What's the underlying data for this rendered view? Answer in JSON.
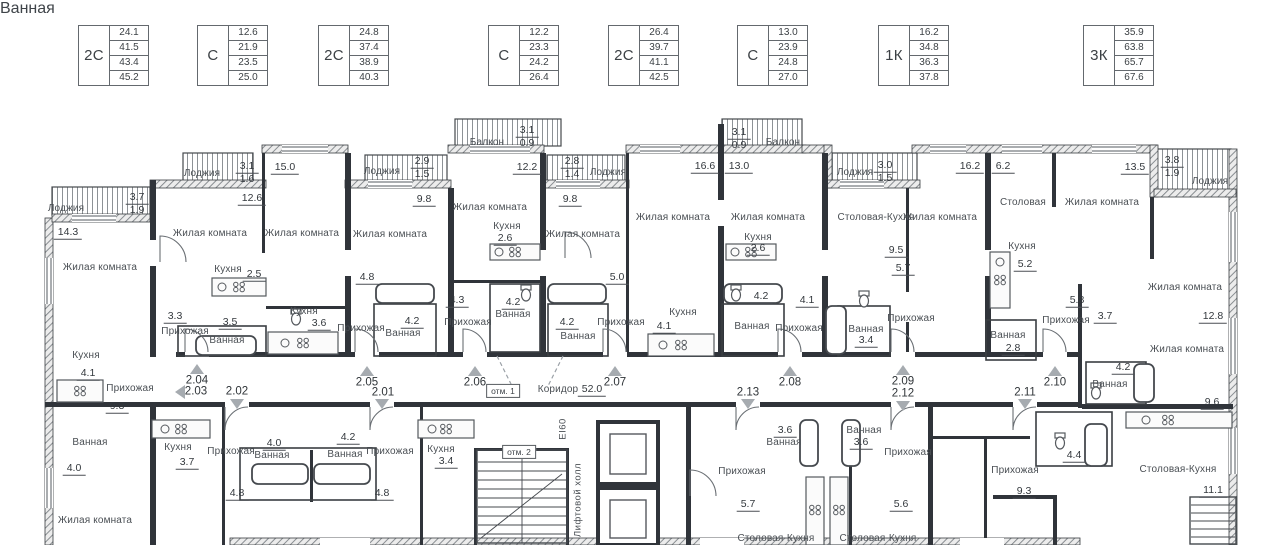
{
  "legend": [
    {
      "type": "2С",
      "values": [
        "24.1",
        "41.5",
        "43.4",
        "45.2"
      ]
    },
    {
      "type": "С",
      "values": [
        "12.6",
        "21.9",
        "23.5",
        "25.0"
      ]
    },
    {
      "type": "2С",
      "values": [
        "24.8",
        "37.4",
        "38.9",
        "40.3"
      ]
    },
    {
      "type": "С",
      "values": [
        "12.2",
        "23.3",
        "24.2",
        "26.4"
      ]
    },
    {
      "type": "2С",
      "values": [
        "26.4",
        "39.7",
        "41.1",
        "42.5"
      ]
    },
    {
      "type": "С",
      "values": [
        "13.0",
        "23.9",
        "24.8",
        "27.0"
      ]
    },
    {
      "type": "1К",
      "values": [
        "16.2",
        "34.8",
        "36.3",
        "37.8"
      ]
    },
    {
      "type": "3К",
      "values": [
        "35.9",
        "63.8",
        "65.7",
        "67.6"
      ]
    }
  ],
  "corridor": {
    "label": "Коридор",
    "area": "52.0"
  },
  "marks": {
    "elevation1": "отм. 1",
    "elevation2": "отм. 2",
    "fire_rating": "EI60",
    "elevator_hall": "Лифтовой холл"
  },
  "apartments": [
    "2.01",
    "2.02",
    "2.03",
    "2.04",
    "2.05",
    "2.06",
    "2.07",
    "2.08",
    "2.09",
    "2.10",
    "2.11",
    "2.12",
    "2.13"
  ],
  "labels": [
    "Лоджия",
    "3.7",
    "1.9",
    "14.3",
    "Жилая комната",
    "Кухня",
    "4.1",
    "Прихожая",
    "9.3",
    "Ванная",
    "4.0",
    "Жилая комната",
    "12.6",
    "Жилая комната",
    "Лоджия",
    "3.1",
    "1.6",
    "15.0",
    "Жилая комната",
    "Кухня",
    "2.5",
    "3.3",
    "Прихожая",
    "3.5",
    "Ванная",
    "Кухня",
    "3.6",
    "Лоджия",
    "2.9",
    "1.5",
    "9.8",
    "Жилая комната",
    "Прихожая",
    "4.2",
    "Ванная",
    "4.8",
    "Балкон",
    "3.1",
    "0.9",
    "12.2",
    "Жилая комната",
    "Кухня",
    "2.6",
    "4.3",
    "Прихожая",
    "4.2",
    "Ванная",
    "Лоджия",
    "2.8",
    "1.4",
    "9.8",
    "Жилая комната",
    "5.0",
    "Кухня",
    "4.1",
    "Прихожая",
    "Ванная",
    "4.2",
    "16.6",
    "13.0",
    "Жилая комната",
    "Жилая комната",
    "Балкон",
    "3.1",
    "0.9",
    "Кухня",
    "2.6",
    "4.2",
    "Ванная",
    "Прихожая",
    "4.1",
    "Лоджия",
    "3.0",
    "1.5",
    "Столовая-Кухня",
    "Жилая комната",
    "9.5",
    "5.7",
    "Ванная",
    "3.4",
    "Прихожая",
    "16.2",
    "6.2",
    "Столовая",
    "Жилая комната",
    "13.5",
    "Лоджия",
    "3.8",
    "1.9",
    "Кухня",
    "5.2",
    "5.8",
    "Прихожая",
    "3.7",
    "Жилая комната",
    "12.8",
    "Жилая комната",
    "4.2",
    "Ванная",
    "9.6",
    "Кухня",
    "3.7",
    "Прихожая",
    "4.0",
    "Ванная",
    "4.8",
    "4.2",
    "Ванная",
    "Прихожая",
    "4.8",
    "Кухня",
    "3.4",
    "Прихожая",
    "5.7",
    "3.6",
    "Ванная",
    "Ванная",
    "3.6",
    "Прихожая",
    "5.6",
    "Столовая-Кухня",
    "Столовая-Кухня",
    "Прихожая",
    "9.3",
    "Ванная",
    "4.4",
    "Столовая-Кухня",
    "11.1",
    "Ванная",
    "2.8"
  ]
}
